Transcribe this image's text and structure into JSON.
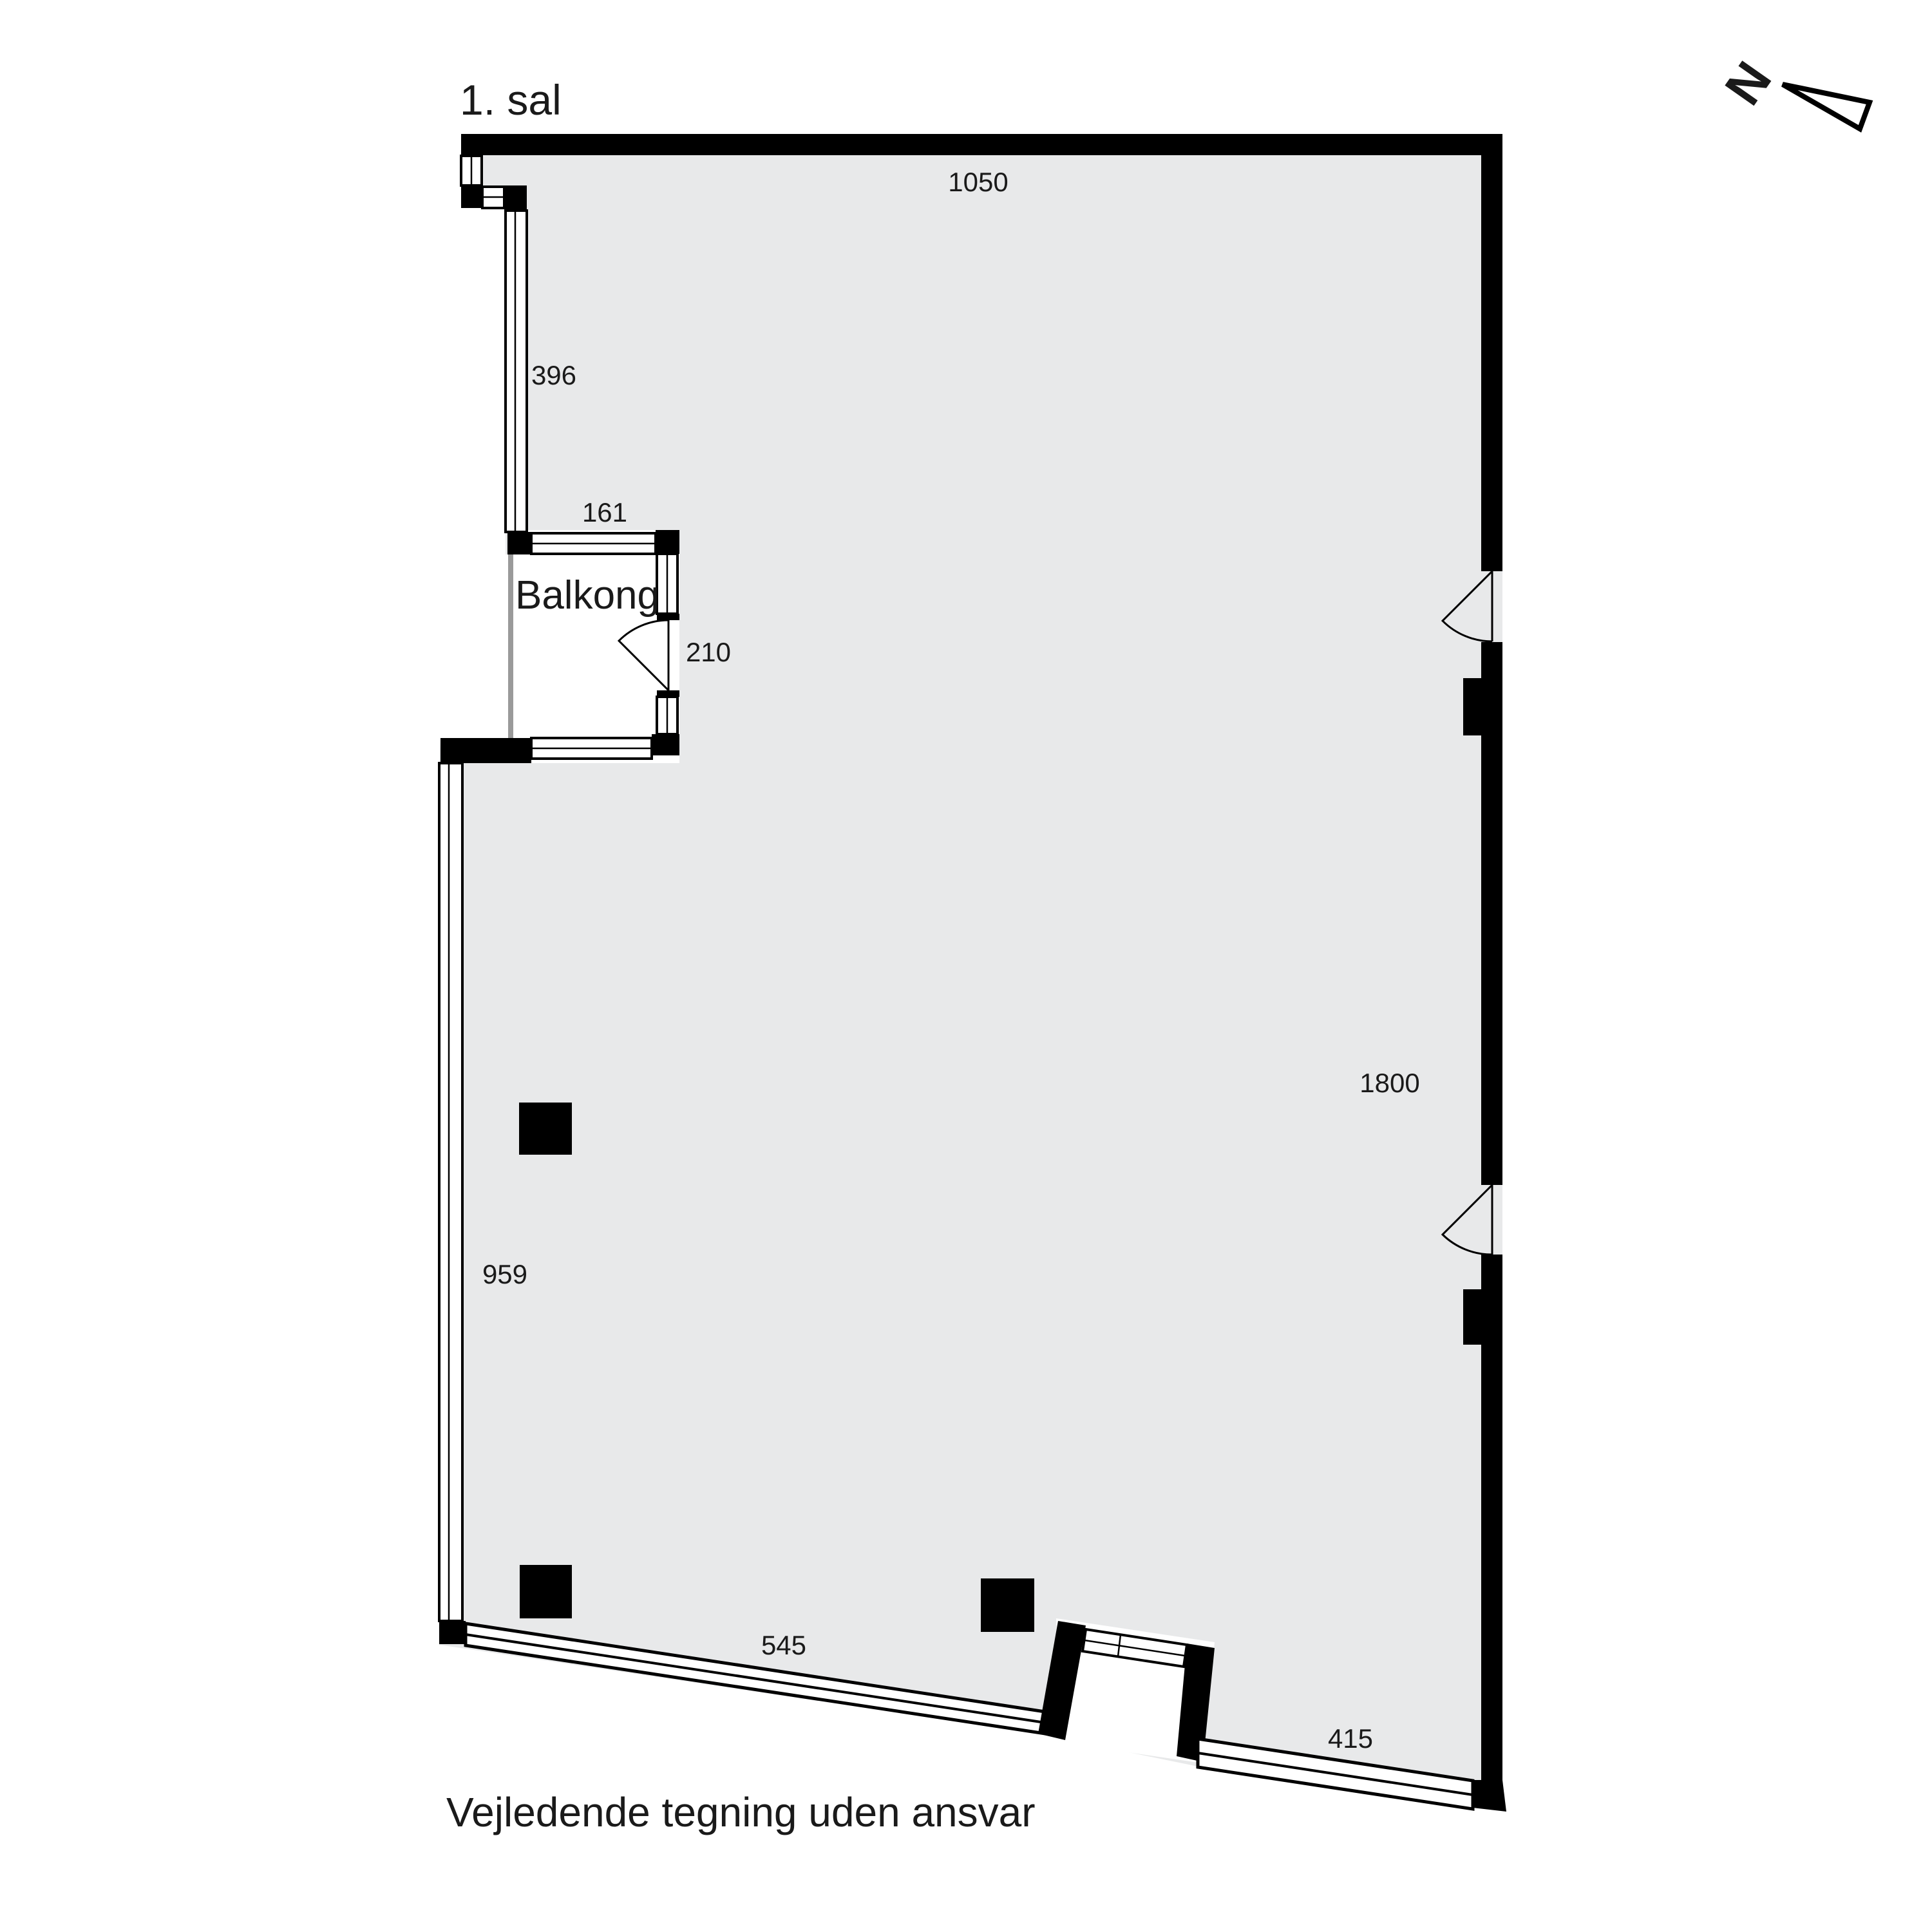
{
  "title": "1. sal",
  "disclaimer": "Vejledende tegning uden ansvar",
  "compass": {
    "north_letter": "N"
  },
  "rooms": {
    "balcony": {
      "label": "Balkong"
    }
  },
  "dimensions": {
    "top_wall": "1050",
    "left_upper_window": "396",
    "balcony_width": "161",
    "balcony_door": "210",
    "right_wall": "1800",
    "left_lower_window": "959",
    "bottom_left_window": "545",
    "bottom_right_window": "415"
  },
  "colors": {
    "background": "#ffffff",
    "floor_fill": "#e8e9ea",
    "wall": "#000000",
    "window_fill": "#ffffff",
    "balcony_open_edge": "#9a9a9a",
    "text": "#1a1a1a"
  }
}
